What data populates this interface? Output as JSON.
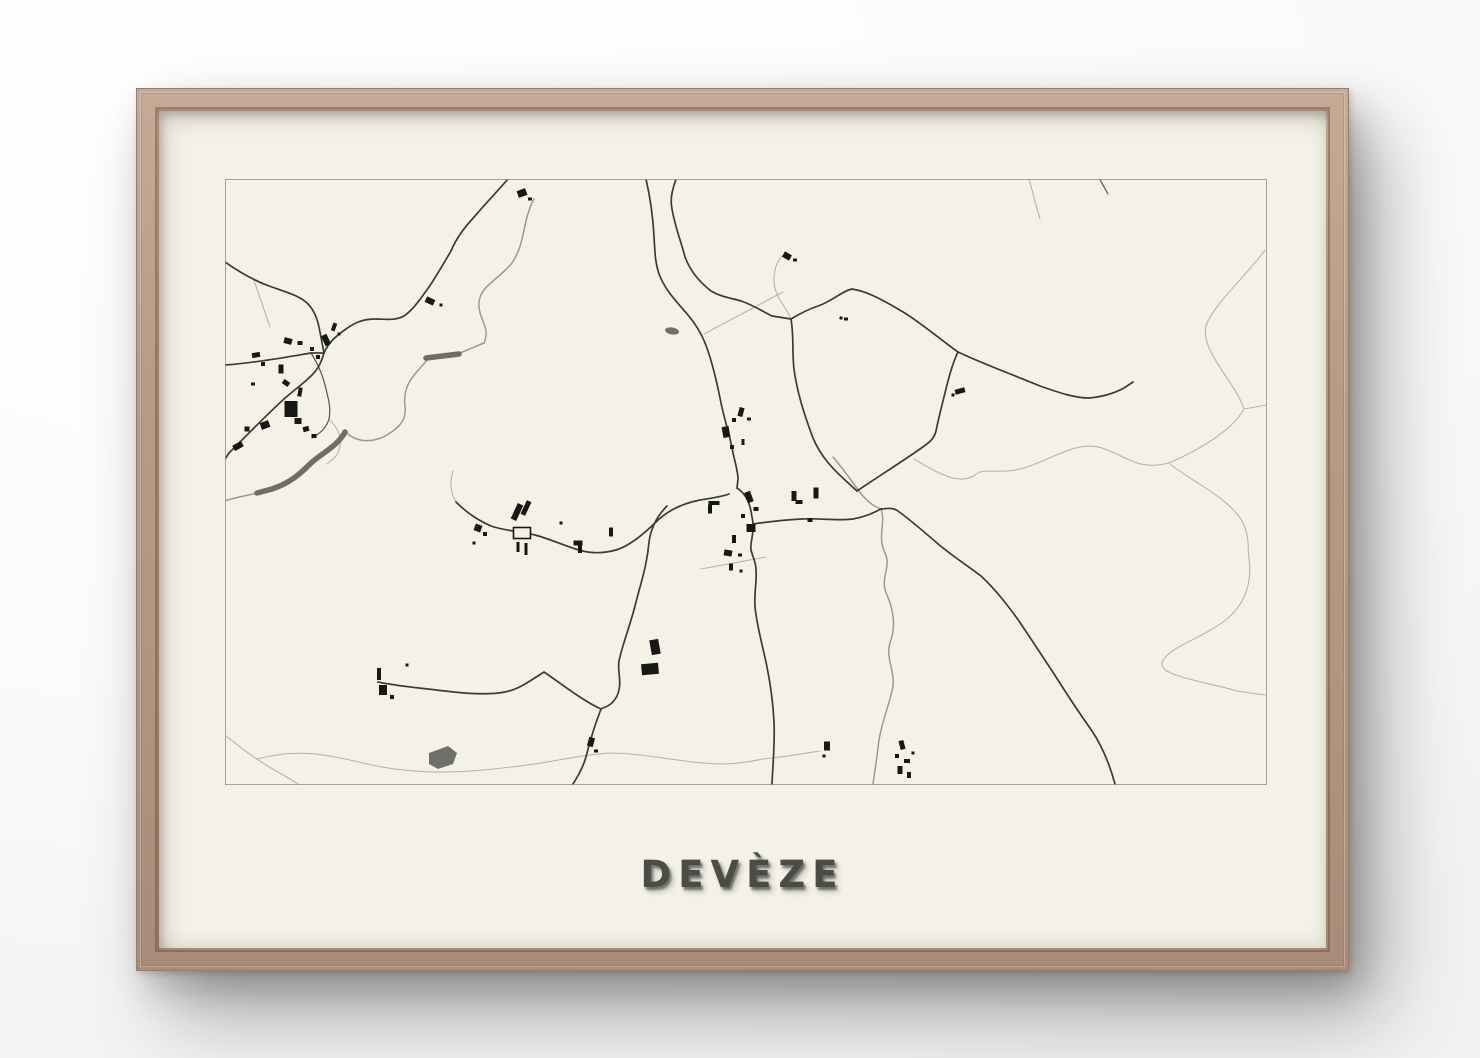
{
  "poster": {
    "title": "DEVÈZE"
  },
  "colors": {
    "wall": "#fbfbfa",
    "frame_wood": "#b79b87",
    "paper": "#f4f2e7",
    "map_border": "#8f8f89",
    "road": "#3b3b36",
    "road_thin": "#55554e",
    "path_light": "#b5b5ad",
    "stream": "#9a9a90",
    "river": "#6e6e66",
    "building": "#171714",
    "title_text": "#4c4c47"
  },
  "map": {
    "x": 224,
    "y": 178,
    "w": 1042,
    "h": 606,
    "lines": [
      {
        "c": "path",
        "d": "M790,318 C783,302 772,295 773,276 C774,263 779,256 785,252"
      },
      {
        "c": "path",
        "d": "M703,333 L782,291"
      },
      {
        "c": "path",
        "d": "M1028,178 C1032,192 1035,205 1039,218"
      },
      {
        "c": "path",
        "d": "M1264,249 C1246,274 1216,300 1206,322 C1196,347 1234,380 1243,408"
      },
      {
        "c": "path",
        "d": "M1243,408 L1266,404"
      },
      {
        "c": "path",
        "d": "M1243,408 C1231,430 1196,450 1168,462"
      },
      {
        "c": "path",
        "d": "M1168,462 C1136,470 1126,455 1101,447 C1071,437 1041,468 1006,470 C987,471 981,468 974,474 C959,485 936,472 913,458"
      },
      {
        "c": "path",
        "d": "M1168,462 C1186,478 1226,495 1241,520 C1250,538 1246,548 1248,557 C1251,580 1246,601 1226,618 C1201,638 1166,646 1161,662 C1159,675 1201,680 1236,690 L1264,694"
      },
      {
        "c": "path",
        "d": "M224,734 C238,745 246,752 256,758"
      },
      {
        "c": "path",
        "d": "M256,758 C300,746 331,755 371,764 C420,775 470,771 510,766 C550,762 581,753 611,752 C650,753 681,762 720,763 C745,763 756,758 771,757 C790,755 806,752 819,750"
      },
      {
        "c": "path",
        "d": "M256,758 C270,768 285,775 297,783"
      },
      {
        "c": "path",
        "d": "M252,277 C258,293 263,309 269,326"
      },
      {
        "c": "path",
        "d": "M452,470 C448,482 450,492 455,501"
      },
      {
        "c": "path",
        "d": "M700,568 L765,556"
      },
      {
        "c": "path",
        "d": "M328,418 C338,428 342,438 338,449 C336,456 330,459 326,463"
      },
      {
        "c": "stream",
        "d": "M533,198 C521,220 525,241 511,262 C496,280 479,285 478,302 C477,318 490,326 483,342 L459,352"
      },
      {
        "c": "stream",
        "d": "M427,358 C416,372 401,381 404,406 C406,420 396,428 386,434 C370,443 356,440 348,434 L344,431"
      },
      {
        "c": "stream",
        "d": "M256,492 C245,495 235,496 224,500"
      },
      {
        "c": "stream",
        "d": "M832,456 C844,470 851,481 861,494 C870,504 875,506 880,508"
      },
      {
        "c": "stream",
        "d": "M880,508 C885,522 876,536 884,552 C891,566 878,578 886,594 C893,610 895,626 889,642 C884,658 896,673 891,690 C887,707 881,721 878,739 C876,756 874,769 872,783"
      },
      {
        "c": "river",
        "d": "M425,357 L458,353"
      },
      {
        "c": "river",
        "d": "M344,431 C336,446 319,453 309,463 C299,473 289,482 271,488 L256,492"
      },
      {
        "c": "road-thin",
        "d": "M310,352 C318,365 322,375 325,388 C328,400 330,408 328,418 C325,428 318,433 311,437"
      },
      {
        "c": "road-thin",
        "d": "M1098,177 L1107,193"
      },
      {
        "c": "road",
        "d": "M507,178 C495,192 484,203 474,215 C462,228 455,238 450,250 C443,262 436,274 428,286 C420,297 412,309 403,315 C394,320 384,318 374,318 C360,318 352,323 345,328 C335,335 327,342 323,352"
      },
      {
        "c": "road",
        "d": "M323,352 C320,362 317,368 311,374 C302,383 292,390 283,398 C272,408 262,418 252,428 C243,437 235,445 228,452 L224,458"
      },
      {
        "c": "road",
        "d": "M224,364 C240,363 253,361 267,359 C281,357 298,354 310,352 L323,352"
      },
      {
        "c": "road",
        "d": "M224,261 C238,271 252,279 268,285 C288,292 299,295 307,303 C314,310 317,320 319,331 L323,352"
      },
      {
        "c": "road",
        "d": "M645,178 C650,200 652,216 653,235 C654,252 654,261 658,273 C665,291 677,302 687,314 C696,325 702,335 707,350 C713,368 716,382 719,397 C723,418 728,431 731,447 C734,462 737,470 737,478 L736,487"
      },
      {
        "c": "road",
        "d": "M675,178 C671,190 669,198 671,208 C674,226 680,240 684,256 C690,272 700,282 710,290 C720,296 730,297 740,300 C752,304 761,310 771,315 L790,318"
      },
      {
        "c": "road",
        "d": "M736,487 C744,492 748,500 750,510 C751,517 752,520 752,523 C753,533 749,541 750,549 C752,557 755,561 755,569 C756,581 753,591 754,606 C756,626 762,646 766,666 C770,686 772,701 773,721 C774,741 772,761 771,783"
      },
      {
        "c": "road",
        "d": "M752,523 C766,521 781,519 800,518 C818,517 835,520 852,518 C864,516 872,512 880,508"
      },
      {
        "c": "road",
        "d": "M790,318 C793,335 791,352 793,368 C796,391 803,413 812,437 C820,456 832,468 845,480 L856,490"
      },
      {
        "c": "road",
        "d": "M856,490 C875,477 899,462 919,448 C929,441 933,438 935,430 C938,415 940,408 944,392 C948,375 952,361 957,351"
      },
      {
        "c": "road",
        "d": "M790,318 C800,312 808,308 817,305 C830,301 841,290 851,288 C865,290 880,298 897,308 C915,318 935,335 957,351 C980,362 1010,373 1039,385 C1059,392 1074,397 1088,397 C1101,396 1114,392 1123,387 L1132,381"
      },
      {
        "c": "road",
        "d": "M880,508 C889,507 893,507 897,510 C908,518 921,529 936,542 C950,554 964,563 980,575 C994,588 1005,602 1018,620 C1030,638 1042,656 1055,676 C1067,695 1079,713 1091,730 C1101,745 1108,761 1114,783"
      },
      {
        "c": "road",
        "d": "M666,505 C656,515 650,526 648,541 C646,565 640,581 634,605 C628,628 621,645 618,660 C616,672 622,681 616,695 C610,706 603,706 600,708 C595,721 590,736 586,752 C583,765 577,775 572,783"
      },
      {
        "c": "road",
        "d": "M455,501 C468,514 479,520 490,525 C504,530 519,530 534,534 C549,538 564,545 578,549 C591,553 604,552 615,549 C629,545 644,532 657,519 C669,508 684,502 699,499 C711,497 720,496 728,493"
      },
      {
        "c": "road",
        "d": "M377,681 C395,685 419,687 444,690 C468,693 489,694 504,691 C519,688 530,679 543,671 C555,679 569,690 582,698 C591,704 596,706 600,708"
      }
    ],
    "buildings": [
      [
        287,
        340,
        8,
        6,
        15
      ],
      [
        299,
        342,
        5,
        4,
        0
      ],
      [
        325,
        339,
        6,
        11,
        -25
      ],
      [
        311,
        348,
        4,
        4,
        0
      ],
      [
        255,
        354,
        8,
        5,
        -10
      ],
      [
        262,
        363,
        4,
        4,
        0
      ],
      [
        280,
        368,
        5,
        9,
        0
      ],
      [
        285,
        382,
        7,
        5,
        35
      ],
      [
        252,
        383,
        4,
        3,
        0
      ],
      [
        299,
        391,
        4,
        9,
        10
      ],
      [
        290,
        408,
        13,
        16,
        0
      ],
      [
        297,
        420,
        7,
        6,
        0
      ],
      [
        264,
        424,
        9,
        7,
        -20
      ],
      [
        246,
        428,
        5,
        5,
        0
      ],
      [
        237,
        445,
        10,
        6,
        -30
      ],
      [
        305,
        428,
        6,
        5,
        -15
      ],
      [
        313,
        435,
        5,
        4,
        0
      ],
      [
        333,
        326,
        4,
        8,
        20
      ],
      [
        338,
        333,
        3,
        3,
        0
      ],
      [
        317,
        356,
        4,
        4,
        0
      ],
      [
        521,
        192,
        9,
        7,
        -20
      ],
      [
        529,
        198,
        4,
        3,
        0
      ],
      [
        429,
        300,
        9,
        6,
        25
      ],
      [
        440,
        304,
        3,
        3,
        0
      ],
      [
        740,
        411,
        5,
        9,
        15
      ],
      [
        733,
        419,
        4,
        4,
        0
      ],
      [
        748,
        418,
        4,
        3,
        0
      ],
      [
        725,
        431,
        7,
        11,
        -10
      ],
      [
        731,
        446,
        4,
        4,
        0
      ],
      [
        742,
        441,
        3,
        6,
        0
      ],
      [
        748,
        496,
        6,
        11,
        -20
      ],
      [
        755,
        508,
        5,
        4,
        0
      ],
      [
        742,
        515,
        4,
        4,
        0
      ],
      [
        750,
        527,
        9,
        8,
        0
      ],
      [
        713,
        502,
        11,
        4,
        0
      ],
      [
        709,
        508,
        4,
        9,
        0
      ],
      [
        733,
        538,
        4,
        8,
        0
      ],
      [
        727,
        552,
        8,
        6,
        10
      ],
      [
        739,
        554,
        4,
        3,
        0
      ],
      [
        730,
        566,
        4,
        7,
        0
      ],
      [
        740,
        570,
        3,
        3,
        0
      ],
      [
        793,
        495,
        5,
        10,
        0
      ],
      [
        798,
        501,
        7,
        4,
        0
      ],
      [
        815,
        492,
        5,
        11,
        0
      ],
      [
        809,
        519,
        5,
        4,
        0
      ],
      [
        840,
        317,
        3,
        3,
        20
      ],
      [
        845,
        318,
        4,
        3,
        0
      ],
      [
        959,
        390,
        10,
        5,
        -15
      ],
      [
        952,
        394,
        3,
        3,
        0
      ],
      [
        786,
        255,
        8,
        6,
        30
      ],
      [
        794,
        259,
        4,
        3,
        0
      ],
      [
        477,
        527,
        7,
        7,
        20
      ],
      [
        484,
        533,
        4,
        4,
        0
      ],
      [
        473,
        542,
        3,
        3,
        0
      ],
      [
        516,
        511,
        6,
        17,
        25
      ],
      [
        525,
        507,
        5,
        15,
        25
      ],
      [
        517,
        546,
        3,
        10,
        0
      ],
      [
        525,
        548,
        3,
        12,
        0
      ],
      [
        577,
        542,
        9,
        5,
        0
      ],
      [
        579,
        548,
        4,
        8,
        0
      ],
      [
        610,
        531,
        4,
        9,
        0
      ],
      [
        560,
        522,
        3,
        3,
        0
      ],
      [
        378,
        673,
        4,
        12,
        0
      ],
      [
        382,
        689,
        8,
        10,
        0
      ],
      [
        391,
        696,
        4,
        4,
        0
      ],
      [
        406,
        664,
        3,
        3,
        0
      ],
      [
        654,
        646,
        9,
        15,
        -10
      ],
      [
        649,
        668,
        17,
        11,
        -5
      ],
      [
        590,
        741,
        6,
        9,
        15
      ],
      [
        595,
        750,
        4,
        3,
        0
      ],
      [
        901,
        744,
        5,
        9,
        -15
      ],
      [
        896,
        755,
        4,
        4,
        0
      ],
      [
        906,
        760,
        6,
        4,
        0
      ],
      [
        899,
        769,
        5,
        8,
        0
      ],
      [
        908,
        774,
        4,
        6,
        0
      ],
      [
        912,
        752,
        3,
        3,
        0
      ],
      [
        826,
        745,
        6,
        9,
        0
      ],
      [
        823,
        755,
        3,
        3,
        0
      ]
    ],
    "outlined_buildings": [
      [
        521,
        532,
        17,
        11,
        0
      ]
    ],
    "ponds": {
      "ellipse": {
        "cx": 671,
        "cy": 330,
        "rx": 7,
        "ry": 3.5,
        "rot": 10
      },
      "polygon": "428,752 447,745 456,752 452,763 437,768 428,763"
    }
  }
}
